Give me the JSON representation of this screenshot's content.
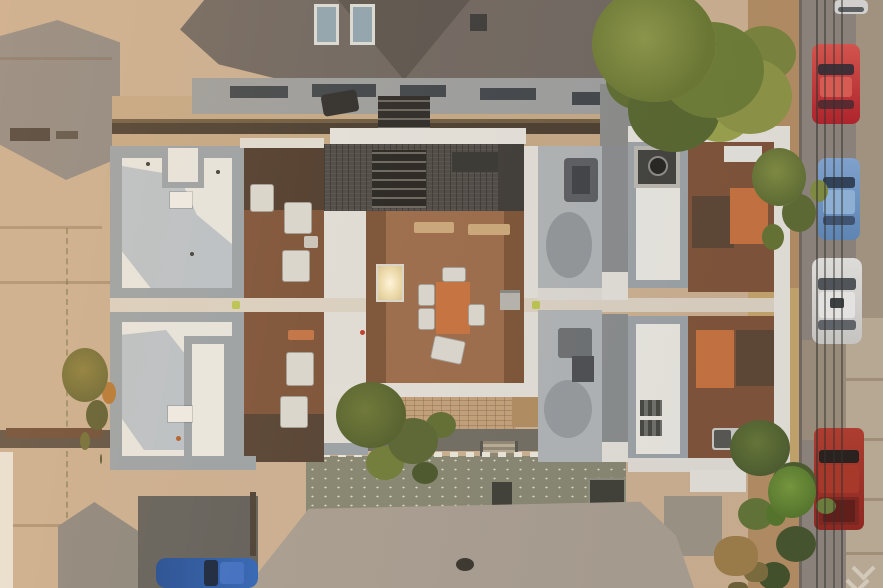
{
  "meta": {
    "type": "aerial-photograph",
    "view": "top-down nadir drone shot",
    "subject": "Modern multi-unit rowhouse with white flat roofs, brown rooftop decks and outdoor furniture, flanked by streets with parked cars, neighboring shingle-roof houses and trees",
    "lighting": "warm hazy late-afternoon light from upper left"
  },
  "palette": {
    "concrete_tan": "#c9ad8e",
    "asphalt_gray": "#8e8781",
    "asphalt_dark": "#5f5d58",
    "roof_white": "#e6e4dd",
    "parapet_gray": "#99a0a4",
    "shadow_blue": "#b9c0c6",
    "deck_brown": "#7c5136",
    "deck_dark": "#5a4330",
    "deck_center": "#9a6a48",
    "table_orange": "#c4703c",
    "shingle_dark": "#6e655e",
    "shingle_light": "#a69b8e",
    "garage_olive": "#84846f",
    "tree_green": "#6f7c33",
    "tree_dark": "#4a5429",
    "bush_orange": "#b5762f",
    "dirt_tan": "#b08a60",
    "walkway_light": "#d9cfbf",
    "car_red": "#c1272d",
    "car_blue": "#6d95c4",
    "car_white": "#d7d6d2",
    "truck_dark_red": "#9c2d24",
    "car_navy": "#2b56a0"
  },
  "objects": {
    "building": "six-unit rowhouse with white flat roofs, gray parapets and wooden roof decks",
    "central_deck": "shared rooftop deck with dining table, chairs, benches and glowing skylight",
    "red_car": "red car parked on right street",
    "blue_car": "light blue car parked on right street",
    "white_car": "white car parked on right street",
    "dark_red_truck": "dark red pickup truck parked on right street",
    "navy_car": "dark blue car in bottom-left driveway (cropped)",
    "white_car_top": "white car at top-right curb (cropped)",
    "top_house": "neighboring house with dark shingle roof and two skylights",
    "bottom_house": "neighboring house with light shingle roof",
    "big_tree": "large green tree at top right",
    "backyard_tree": "tree overhanging rear courtyard",
    "left_street": "concrete street and sidewalk on the left",
    "right_street": "asphalt street with parallel parking on the right",
    "power_lines": "overhead utility lines along right street"
  }
}
